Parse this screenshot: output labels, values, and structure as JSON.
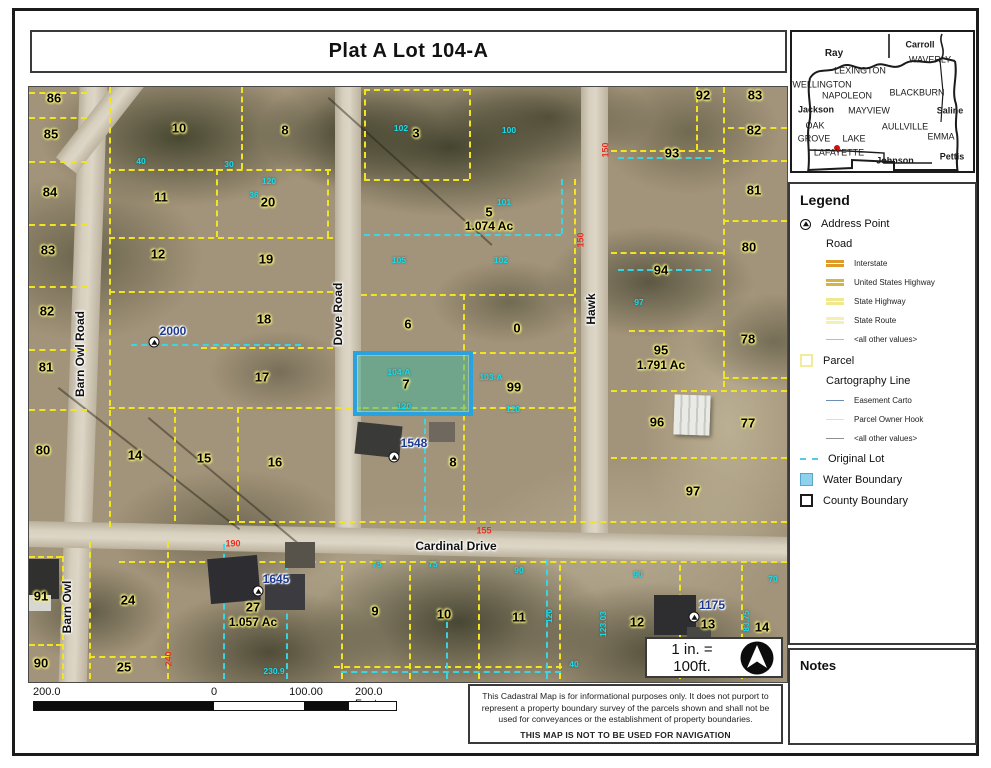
{
  "title": "Plat A Lot 104-A",
  "scale_note": "1 in. = 100ft.",
  "notes_title": "Notes",
  "scalebar": {
    "left_label": "200.0",
    "zero_label": "0",
    "mid_label": "100.00",
    "right_label": "200.0 Feet"
  },
  "disclaimer": {
    "line1": "This Cadastral Map is for informational purposes only.  It does not purport to",
    "line2": "represent a property boundary survey of the parcels shown and shall not be",
    "line3": "used for conveyances or the establishment of property boundaries.",
    "line4": "THIS MAP IS NOT TO BE USED FOR NAVIGATION"
  },
  "legend": {
    "title": "Legend",
    "address_point": "Address Point",
    "road_header": "Road",
    "road_items": [
      {
        "label": "Interstate",
        "color": "#df9a28",
        "double": true
      },
      {
        "label": "United States Highway",
        "color": "#d3b445",
        "double": true
      },
      {
        "label": "State Highway",
        "color": "#efe88d",
        "double": true
      },
      {
        "label": "State Route",
        "color": "#f4f0b4",
        "double": true
      },
      {
        "label": "<all other values>",
        "color": "#bbbbbb",
        "double": false
      }
    ],
    "parcel": "Parcel",
    "carto_header": "Cartography Line",
    "carto_items": [
      {
        "label": "Easement Carto",
        "color": "#6b8fb3"
      },
      {
        "label": "Parcel Owner Hook",
        "color": "#ece393"
      },
      {
        "label": "<all other values>",
        "color": "#8f8f8f"
      }
    ],
    "original_lot": "Original Lot",
    "water_boundary": "Water Boundary",
    "county_boundary": "County Boundary",
    "parcel_color": "#f0ec9c",
    "original_lot_color": "#4fcfe0",
    "water_fill": "#8ed1ec",
    "water_border": "#55a8cc",
    "marker_color": "#cc1111"
  },
  "inset_map": {
    "labels": [
      {
        "text": "Ray",
        "x": 42,
        "y": 22,
        "size": 10,
        "bold": true
      },
      {
        "text": "Carroll",
        "x": 128,
        "y": 13,
        "size": 9,
        "bold": true
      },
      {
        "text": "WAVERLY",
        "x": 138,
        "y": 28,
        "size": 9,
        "bold": false
      },
      {
        "text": "LEXINGTON",
        "x": 68,
        "y": 39,
        "size": 9,
        "bold": false
      },
      {
        "text": "WELLINGTON",
        "x": 30,
        "y": 53,
        "size": 9,
        "bold": false
      },
      {
        "text": "NAPOLEON",
        "x": 55,
        "y": 64,
        "size": 9,
        "bold": false
      },
      {
        "text": "BLACKBURN",
        "x": 125,
        "y": 61,
        "size": 9,
        "bold": false
      },
      {
        "text": "Jackson",
        "x": 24,
        "y": 78,
        "size": 9,
        "bold": true
      },
      {
        "text": "MAYVIEW",
        "x": 77,
        "y": 79,
        "size": 9,
        "bold": false
      },
      {
        "text": "Saline",
        "x": 158,
        "y": 79,
        "size": 9,
        "bold": true
      },
      {
        "text": "OAK",
        "x": 23,
        "y": 94,
        "size": 9,
        "bold": false
      },
      {
        "text": "AULLVILLE",
        "x": 113,
        "y": 95,
        "size": 9,
        "bold": false
      },
      {
        "text": "GROVE",
        "x": 22,
        "y": 107,
        "size": 9,
        "bold": false
      },
      {
        "text": "LAKE",
        "x": 62,
        "y": 107,
        "size": 9,
        "bold": false
      },
      {
        "text": "EMMA",
        "x": 149,
        "y": 105,
        "size": 9,
        "bold": false
      },
      {
        "text": "LAFAYETTE",
        "x": 47,
        "y": 121,
        "size": 9,
        "bold": false
      },
      {
        "text": "Johnson",
        "x": 103,
        "y": 129,
        "size": 9,
        "bold": true
      },
      {
        "text": "Pettis",
        "x": 160,
        "y": 125,
        "size": 9,
        "bold": true
      }
    ]
  },
  "map": {
    "road_labels": [
      {
        "text": "Barn Owl Road",
        "x": 51,
        "y": 267,
        "rot": -90
      },
      {
        "text": "Dove Road",
        "x": 309,
        "y": 227,
        "rot": -90
      },
      {
        "text": "Hawk",
        "x": 562,
        "y": 222,
        "rot": -90
      },
      {
        "text": "Barn Owl",
        "x": 38,
        "y": 520,
        "rot": -90
      },
      {
        "text": "Cardinal Drive",
        "x": 427,
        "y": 459,
        "rot": 0
      }
    ],
    "parcel_labels": [
      {
        "text": "86",
        "x": 25,
        "y": 11
      },
      {
        "text": "85",
        "x": 22,
        "y": 47
      },
      {
        "text": "84",
        "x": 21,
        "y": 105
      },
      {
        "text": "83",
        "x": 19,
        "y": 163
      },
      {
        "text": "82",
        "x": 18,
        "y": 224
      },
      {
        "text": "81",
        "x": 17,
        "y": 280
      },
      {
        "text": "80",
        "x": 14,
        "y": 363
      },
      {
        "text": "91",
        "x": 12,
        "y": 509
      },
      {
        "text": "90",
        "x": 12,
        "y": 576
      },
      {
        "text": "10",
        "x": 150,
        "y": 41
      },
      {
        "text": "8",
        "x": 256,
        "y": 43
      },
      {
        "text": "11",
        "x": 132,
        "y": 110
      },
      {
        "text": "20",
        "x": 239,
        "y": 115
      },
      {
        "text": "12",
        "x": 129,
        "y": 167
      },
      {
        "text": "19",
        "x": 237,
        "y": 172
      },
      {
        "text": "18",
        "x": 235,
        "y": 232
      },
      {
        "text": "17",
        "x": 233,
        "y": 290
      },
      {
        "text": "14",
        "x": 106,
        "y": 368
      },
      {
        "text": "15",
        "x": 175,
        "y": 371
      },
      {
        "text": "16",
        "x": 246,
        "y": 375
      },
      {
        "text": "3",
        "x": 387,
        "y": 46
      },
      {
        "text": "5",
        "x": 460,
        "y": 125
      },
      {
        "text": "1.074 Ac",
        "x": 460,
        "y": 139,
        "ac": true
      },
      {
        "text": "6",
        "x": 379,
        "y": 237
      },
      {
        "text": "0",
        "x": 488,
        "y": 241
      },
      {
        "text": "7",
        "x": 377,
        "y": 297
      },
      {
        "text": "99",
        "x": 485,
        "y": 300
      },
      {
        "text": "8",
        "x": 424,
        "y": 375
      },
      {
        "text": "92",
        "x": 674,
        "y": 8
      },
      {
        "text": "83",
        "x": 726,
        "y": 8
      },
      {
        "text": "82",
        "x": 725,
        "y": 43
      },
      {
        "text": "93",
        "x": 643,
        "y": 66
      },
      {
        "text": "81",
        "x": 725,
        "y": 103
      },
      {
        "text": "80",
        "x": 720,
        "y": 160
      },
      {
        "text": "94",
        "x": 632,
        "y": 183
      },
      {
        "text": "95",
        "x": 632,
        "y": 263
      },
      {
        "text": "1.791 Ac",
        "x": 632,
        "y": 278,
        "ac": true
      },
      {
        "text": "78",
        "x": 719,
        "y": 252
      },
      {
        "text": "96",
        "x": 628,
        "y": 335
      },
      {
        "text": "77",
        "x": 719,
        "y": 336
      },
      {
        "text": "97",
        "x": 664,
        "y": 404
      },
      {
        "text": "24",
        "x": 99,
        "y": 513
      },
      {
        "text": "25",
        "x": 95,
        "y": 580
      },
      {
        "text": "27",
        "x": 224,
        "y": 520
      },
      {
        "text": "1.057 Ac",
        "x": 224,
        "y": 535,
        "ac": true
      },
      {
        "text": "9",
        "x": 346,
        "y": 524
      },
      {
        "text": "10",
        "x": 415,
        "y": 527
      },
      {
        "text": "11",
        "x": 490,
        "y": 530
      },
      {
        "text": "12",
        "x": 608,
        "y": 535
      },
      {
        "text": "13",
        "x": 679,
        "y": 537
      },
      {
        "text": "14",
        "x": 733,
        "y": 540
      }
    ],
    "addresses": [
      {
        "text": "2000",
        "x": 144,
        "y": 244
      },
      {
        "text": "1548",
        "x": 385,
        "y": 356
      },
      {
        "text": "1645",
        "x": 247,
        "y": 492
      },
      {
        "text": "1175",
        "x": 683,
        "y": 518
      }
    ],
    "address_icons": [
      {
        "x": 125,
        "y": 255
      },
      {
        "x": 365,
        "y": 370
      },
      {
        "x": 229,
        "y": 504
      },
      {
        "x": 665,
        "y": 530
      }
    ],
    "dims_cyan": [
      {
        "text": "40",
        "x": 112,
        "y": 74
      },
      {
        "text": "30",
        "x": 200,
        "y": 77
      },
      {
        "text": "120",
        "x": 240,
        "y": 94
      },
      {
        "text": "36",
        "x": 225,
        "y": 108
      },
      {
        "text": "102",
        "x": 372,
        "y": 41
      },
      {
        "text": "100",
        "x": 480,
        "y": 43
      },
      {
        "text": "101",
        "x": 475,
        "y": 115
      },
      {
        "text": "105",
        "x": 370,
        "y": 173
      },
      {
        "text": "102",
        "x": 472,
        "y": 173
      },
      {
        "text": "97",
        "x": 610,
        "y": 215
      },
      {
        "text": "104-A",
        "x": 370,
        "y": 285
      },
      {
        "text": "103-A",
        "x": 462,
        "y": 290
      },
      {
        "text": "120",
        "x": 375,
        "y": 319
      },
      {
        "text": "120",
        "x": 484,
        "y": 322
      },
      {
        "text": "75",
        "x": 348,
        "y": 477
      },
      {
        "text": "75",
        "x": 404,
        "y": 477
      },
      {
        "text": "90",
        "x": 490,
        "y": 483
      },
      {
        "text": "90",
        "x": 609,
        "y": 487
      },
      {
        "text": "70",
        "x": 744,
        "y": 492
      },
      {
        "text": "40",
        "x": 545,
        "y": 577
      },
      {
        "text": "230.9",
        "x": 245,
        "y": 584
      },
      {
        "text": "120",
        "x": 520,
        "y": 529,
        "rot": -90
      },
      {
        "text": "123.03",
        "x": 574,
        "y": 537,
        "rot": -90
      },
      {
        "text": "83.75",
        "x": 717,
        "y": 534,
        "rot": -90
      }
    ],
    "dims_red": [
      {
        "text": "150",
        "x": 577,
        "y": 63,
        "rot": -90
      },
      {
        "text": "150",
        "x": 552,
        "y": 153,
        "rot": -90
      },
      {
        "text": "155",
        "x": 455,
        "y": 444
      },
      {
        "text": "190",
        "x": 204,
        "y": 457
      },
      {
        "text": "240",
        "x": 140,
        "y": 572,
        "rot": -90
      }
    ]
  }
}
